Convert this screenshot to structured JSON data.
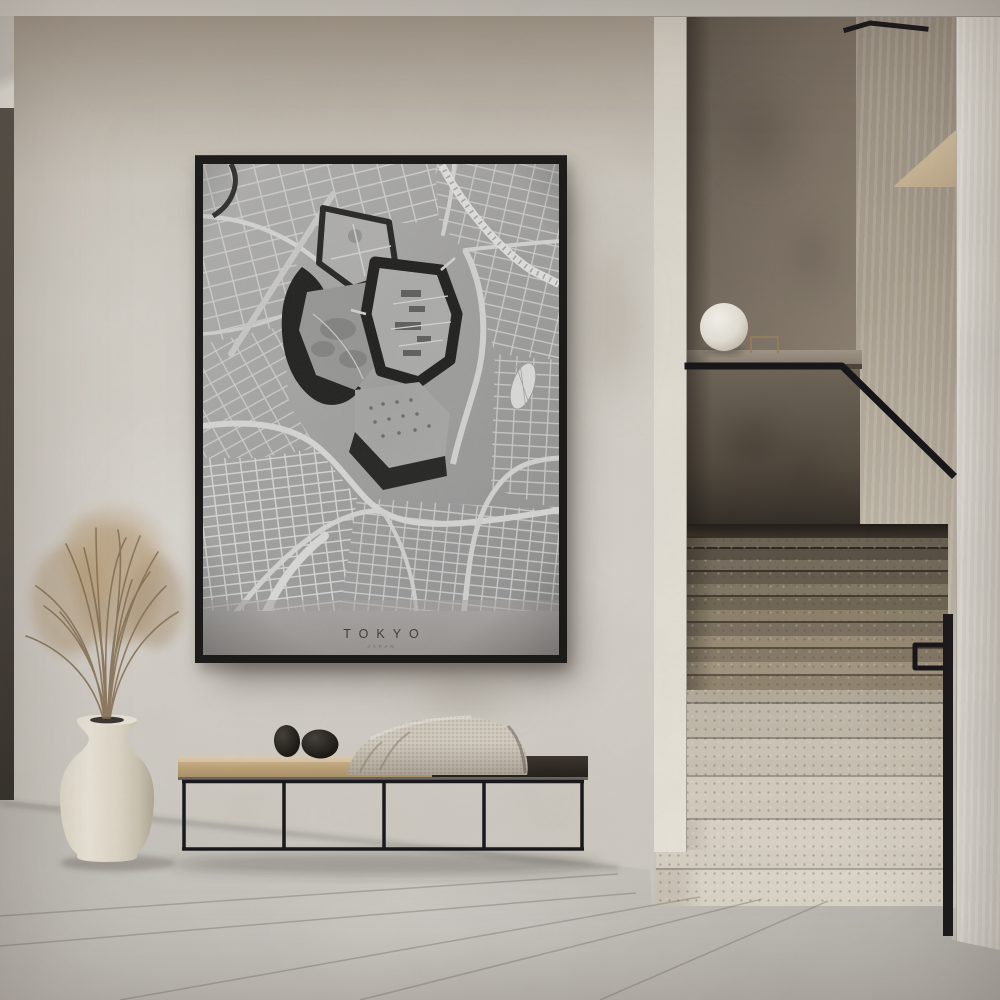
{
  "scene": {
    "label": "Interior hallway with framed Tokyo city-map poster, wood bench with decor stones and knit throw, cream vase with dried pampas grass, and terrazzo staircase with black handrail and globe lamp"
  },
  "poster": {
    "title": "TOKYO",
    "subtitle": "JAPAN"
  },
  "palette": {
    "wall": "#d4cfc7",
    "wall_shadow": "#8b8173",
    "ceiling": "#d9d6cf",
    "door_frame": "#514d45",
    "floor": "#cdcac4",
    "grout": "#8f8b84",
    "frame_black": "#1a1918",
    "map_paper": "#a6a6a6",
    "map_street": "#d9d9d9",
    "map_moat": "#1f1f1f",
    "map_park": "#b2b2b2",
    "stair_upper": "#8a7e6c",
    "stair_lower": "#ddd6c9",
    "metal_black": "#141317",
    "column": "#e9e6df",
    "bench_wood": "#c9ad81",
    "bench_dark": "#2e2923",
    "blanket": "#d6d0c3",
    "pebble": "#1d1a16",
    "vase": "#ece6d8",
    "grass": "#a78c67",
    "lamp": "#f2f0e9",
    "wedge_shelf": "#d3c2a2",
    "ledge": "#968c7f",
    "half_wall": "#5e564b"
  }
}
